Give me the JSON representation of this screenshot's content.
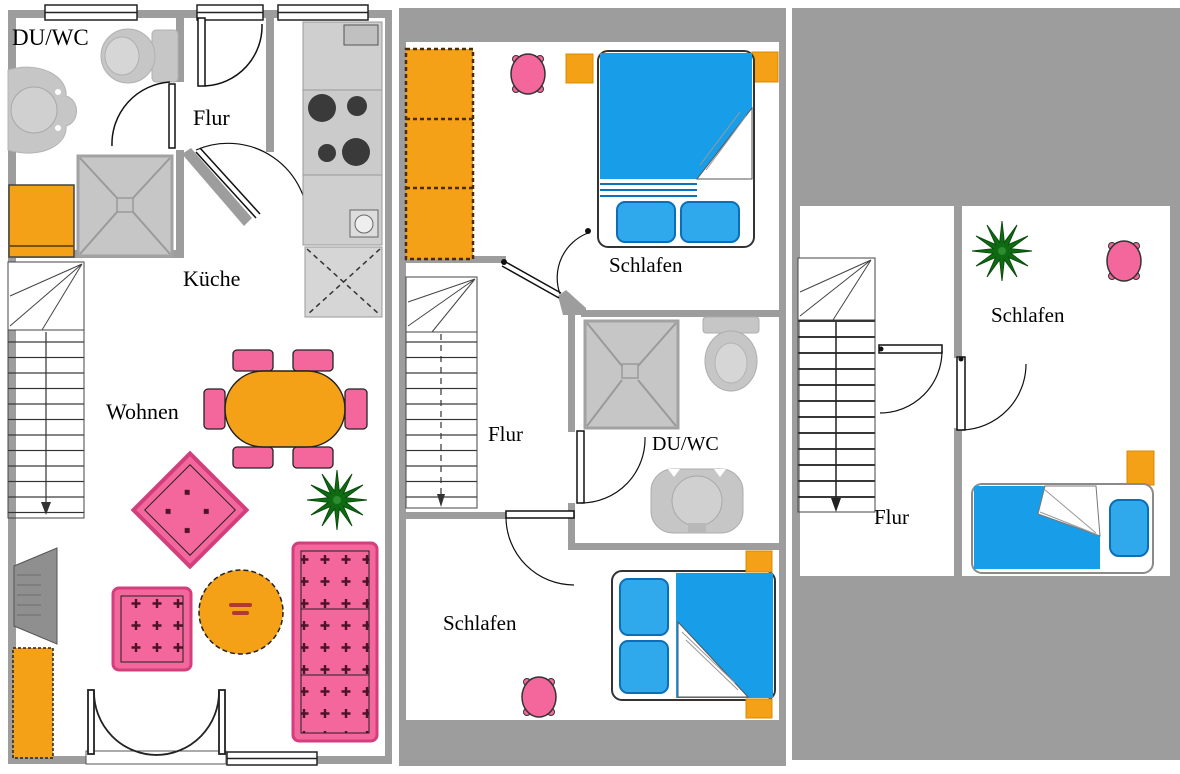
{
  "image_type": "architectural floor plan, 3 storeys side by side",
  "floors": [
    {
      "name": "floor-1",
      "rooms": [
        {
          "label": "DU/WC"
        },
        {
          "label": "Flur"
        },
        {
          "label": "Küche"
        },
        {
          "label": "Wohnen"
        }
      ],
      "furniture": [
        "toilet-icon",
        "washbasin-icon",
        "shower-icon",
        "washing-machine-icon",
        "stove-icon",
        "kitchen-counter-icon",
        "fridge-icon",
        "staircase-icon",
        "dining-table-icon",
        "chair-icon",
        "rug-icon",
        "tv-icon",
        "sideboard-icon",
        "armchair-icon",
        "coffee-table-icon",
        "sofa-icon",
        "plant-icon",
        "french-door-icon",
        "window-icon"
      ]
    },
    {
      "name": "floor-2",
      "rooms": [
        {
          "label": "Schlafen"
        },
        {
          "label": "Flur"
        },
        {
          "label": "DU/WC"
        },
        {
          "label": "Schlafen"
        }
      ],
      "furniture": [
        "wardrobe-icon",
        "double-bed-icon",
        "pillow-icon",
        "stool-icon",
        "nightstand-icon",
        "staircase-icon",
        "shower-icon",
        "toilet-icon",
        "washbasin-icon",
        "door-icon"
      ]
    },
    {
      "name": "floor-3",
      "rooms": [
        {
          "label": "Schlafen"
        },
        {
          "label": "Flur"
        }
      ],
      "furniture": [
        "single-bed-icon",
        "pillow-icon",
        "stool-icon",
        "nightstand-icon",
        "plant-icon",
        "staircase-icon",
        "door-icon"
      ]
    }
  ],
  "colors": {
    "wall": "#9d9d9d",
    "fixture": "#c6c6c6",
    "fixture_border": "#a8a8a8",
    "furniture_orange": "#f5a118",
    "orange_border": "#7a4a00",
    "furniture_pink": "#f4679c",
    "pink_border": "#d23f7c",
    "bed_blue": "#189de9",
    "pillow_blue": "#2fa8ec",
    "pillow_border": "#0b6fb8",
    "plant_green": "#0e6b12",
    "burner_dark": "#3a3a3a",
    "tv_gray": "#8f8f8f",
    "line_dark": "#222222"
  }
}
